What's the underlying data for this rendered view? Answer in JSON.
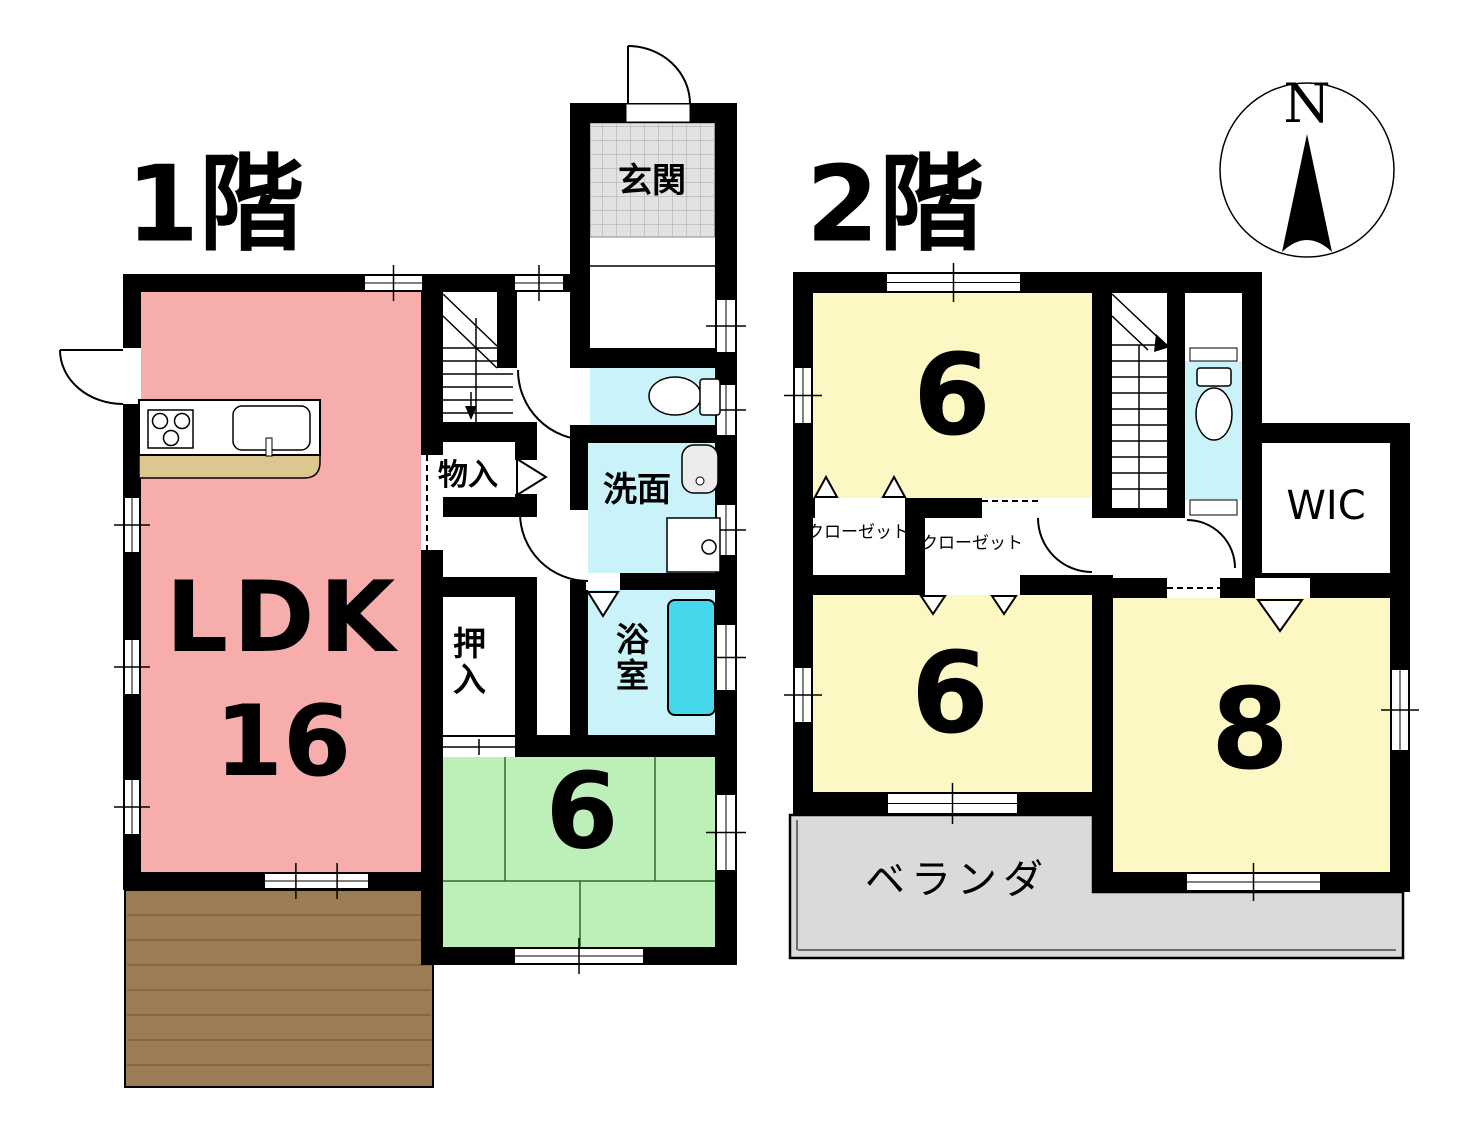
{
  "document": {
    "type": "floor-plan",
    "units": "tatami-mats"
  },
  "compass": {
    "north": "N"
  },
  "floor1": {
    "title": "1階",
    "ldk": {
      "label": "LDK",
      "size": "16"
    },
    "entrance": {
      "label": "玄関"
    },
    "storage": {
      "label": "物入"
    },
    "futon_closet": {
      "label": "押入"
    },
    "washroom": {
      "label": "洗面"
    },
    "bathroom": {
      "label": "浴室"
    },
    "tatami_room": {
      "size": "6"
    }
  },
  "floor2": {
    "title": "2階",
    "bedroom_north": {
      "size": "6"
    },
    "closet_left": {
      "label": "クローゼット"
    },
    "closet_right": {
      "label": "クローゼット"
    },
    "wic": {
      "label": "WIC"
    },
    "bedroom_southwest": {
      "size": "6"
    },
    "bedroom_southeast": {
      "size": "8"
    },
    "balcony": {
      "label": "ベランダ"
    }
  },
  "colors": {
    "wall": "#000000",
    "ldk_pink": "#f8adad",
    "tatami_green": "#bdf0b8",
    "bedroom_yellow": "#fdf8c3",
    "water_room_cyan": "#c9f3f8",
    "bathtub_cyan": "#45d7ec",
    "entrance_tile": "#e2e2e2",
    "balcony_gray": "#dadada",
    "deck_brown": "#9b7c55",
    "counter_tan": "#dcc88e"
  }
}
